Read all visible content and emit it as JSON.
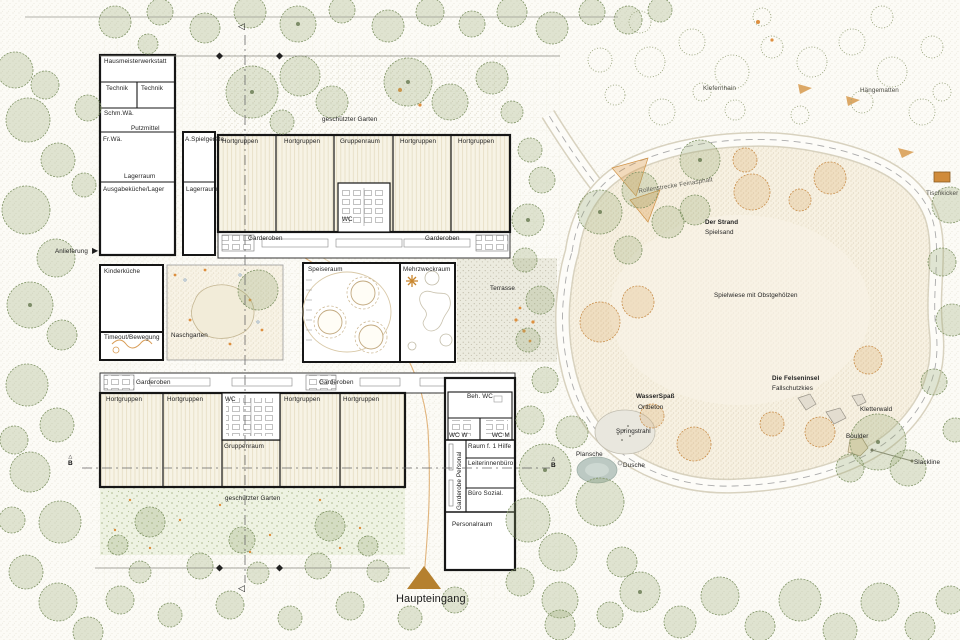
{
  "icons": {
    "arrow_right": "▶",
    "section_arrow": "◁",
    "marker_triangle": "△"
  },
  "service_wing": {
    "hausmeisterwerkstatt": "Hausmeisterwerkstatt",
    "technik_1": "Technik",
    "technik_2": "Technik",
    "schm_wae": "Schm.Wä.",
    "putzmittel": "Putzmittel",
    "fr_wae": "Fr.Wä.",
    "lagerraum": "Lagerraum",
    "ausgabekueche": "Ausgabeküche/Lager",
    "a_spielgeraete": "A.Spielgeräte",
    "lagerraum_2": "Lagerraum"
  },
  "top_wing": {
    "rooms": [
      "Hortgruppen",
      "Hortgruppen",
      "Gruppenraum",
      "Hortgruppen",
      "Hortgruppen"
    ],
    "wc": "WC",
    "garderoben_left": "Garderoben",
    "garderoben_right": "Garderoben",
    "garten": "geschützter Garten"
  },
  "mid": {
    "anlieferung": "Anlieferung",
    "kinderkueche": "Kinderküche",
    "timeout": "Timeout/Bewegung",
    "naschgarten": "Naschgarten",
    "speiseraum": "Speiseraum",
    "mehrzweckraum": "Mehrzweckraum",
    "terrasse": "Terrasse"
  },
  "lower_wing": {
    "garderoben_left": "Garderoben",
    "garderoben_right": "Garderoben",
    "rooms": [
      "Hortgruppen",
      "Hortgruppen",
      "Hortgruppen",
      "Hortgruppen"
    ],
    "wc": "WC",
    "gruppenraum": "Gruppenraum",
    "garten": "geschützter Garten"
  },
  "entrance_wing": {
    "beh_wc": "Beh. WC",
    "wc_w": "WC W",
    "wc_m": "WC M",
    "erste_hilfe": "Raum f. 1 Hilfe",
    "leiterinnenbuero": "Leiterinnenbüro",
    "garderobe_personal": "Garderobe Personal",
    "buero_sozial": "Büro Sozial.",
    "personalraum": "Personalraum"
  },
  "entrance": {
    "label": "Haupteingang"
  },
  "playground": {
    "kiefernhain": "Kiefernhain",
    "haengematten": "Hängematten",
    "rollenstrecke": "Rollenstrecke Feinasphalt",
    "tischkicker": "Tischkicker",
    "strand_title": "Der Strand",
    "strand_sub": "Spielsand",
    "spielwiese": "Spielwiese mit Obstgehölzen",
    "felseninsel_title": "Die Felseninsel",
    "felseninsel_sub": "Fallschutzkies",
    "wasserspass_title": "WasserSpaß",
    "wasserspass_sub": "Ortbeton",
    "springstrahl": "Springstrahl",
    "plansche": "Plansche",
    "dusche": "Dusche",
    "kletterwald": "Kletterwald",
    "boulder": "Boulder",
    "slackline": "Slackline"
  },
  "sections": {
    "b_left": "B",
    "b_right": "B"
  },
  "colors": {
    "wall": "#1a1a1a",
    "accent_orange": "#b5802f",
    "tree_green": "#7f9365"
  }
}
